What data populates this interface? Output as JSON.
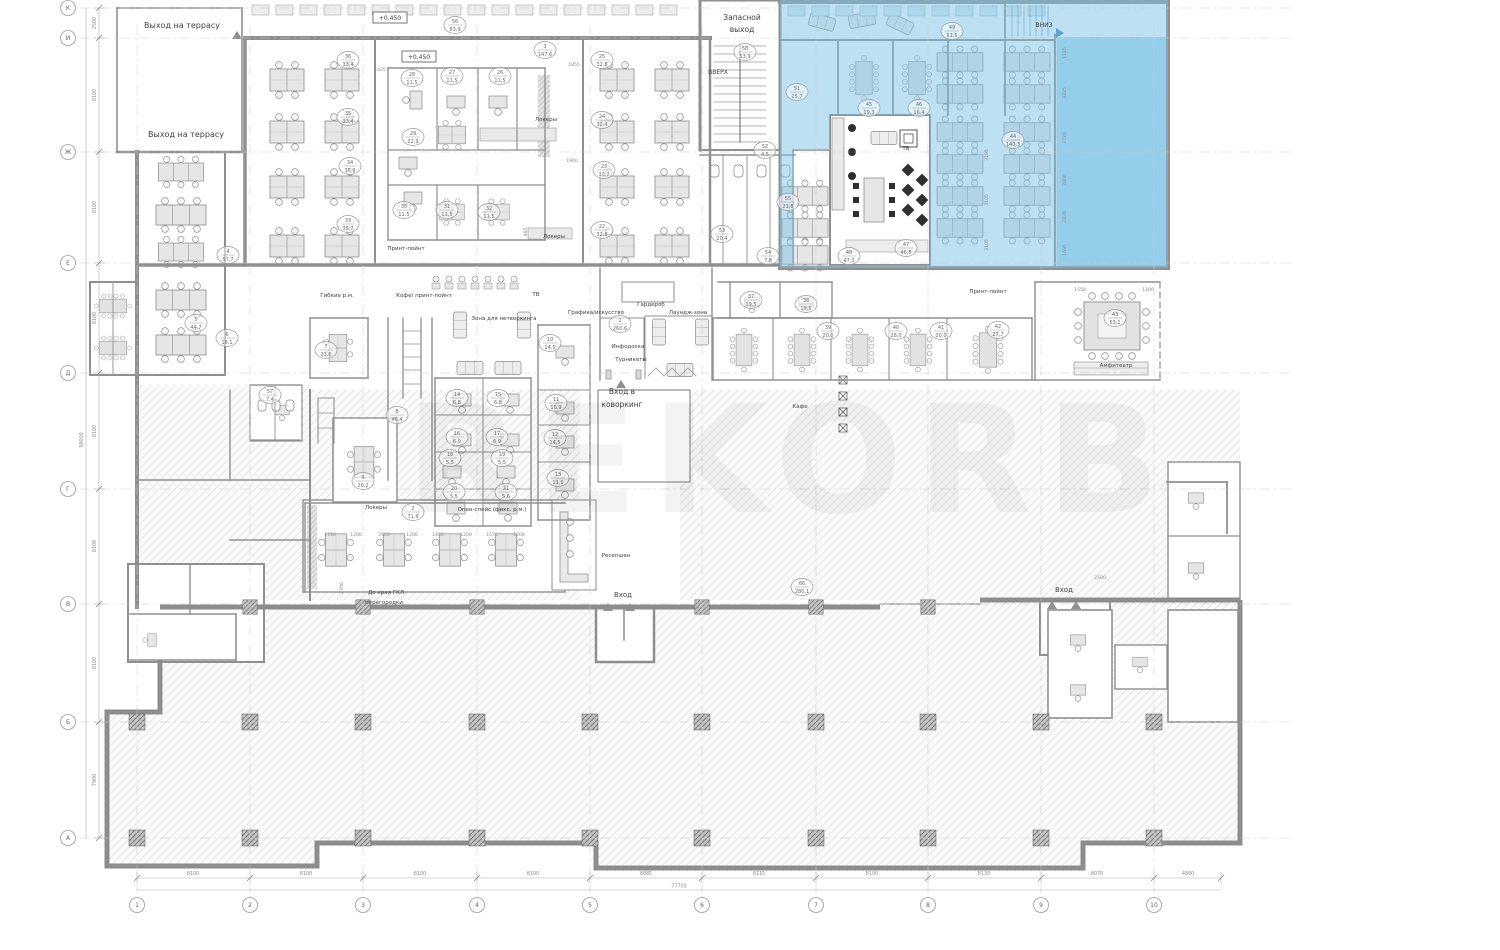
{
  "drawing": {
    "type": "architectural-floor-plan",
    "floor_note": "office coworking floor plan with highlighted lease zone",
    "watermark": {
      "text": "REKORB",
      "opacity": 0.045
    }
  },
  "colors": {
    "blue": "#7cc4e8",
    "blue_deep": "#64b7e2",
    "wall": "#8f8f8f",
    "wall_dark": "#6f6f6f",
    "furn_fill": "#e6e6e6",
    "furn_stroke": "#8f8f8f",
    "hatch_line": "#dedede",
    "label": "#3f3f3f",
    "dim": "#8a8a8a",
    "grid": "#c9c9c9"
  },
  "grid": {
    "cols": [
      {
        "label": "1",
        "x": 137
      },
      {
        "label": "2",
        "x": 250
      },
      {
        "label": "3",
        "x": 363
      },
      {
        "label": "4",
        "x": 477
      },
      {
        "label": "5",
        "x": 590
      },
      {
        "label": "6",
        "x": 702
      },
      {
        "label": "7",
        "x": 816
      },
      {
        "label": "8",
        "x": 928
      },
      {
        "label": "9",
        "x": 1041
      },
      {
        "label": "10",
        "x": 1154
      }
    ],
    "rows": [
      {
        "label": "К",
        "y": 8
      },
      {
        "label": "И",
        "y": 38
      },
      {
        "label": "Ж",
        "y": 152
      },
      {
        "label": "Е",
        "y": 263
      },
      {
        "label": "Д",
        "y": 373
      },
      {
        "label": "Г",
        "y": 489
      },
      {
        "label": "В",
        "y": 604
      },
      {
        "label": "Б",
        "y": 722
      },
      {
        "label": "А",
        "y": 838
      }
    ],
    "col_dims": [
      {
        "t": "8100",
        "x": 193
      },
      {
        "t": "8100",
        "x": 306
      },
      {
        "t": "8100",
        "x": 420
      },
      {
        "t": "8100",
        "x": 533
      },
      {
        "t": "8085",
        "x": 646
      },
      {
        "t": "8115",
        "x": 759
      },
      {
        "t": "8100",
        "x": 872
      },
      {
        "t": "8130",
        "x": 984
      },
      {
        "t": "8070",
        "x": 1097
      },
      {
        "t": "4800",
        "x": 1188
      }
    ],
    "row_dims": [
      {
        "t": "2500",
        "y": 23
      },
      {
        "t": "8100",
        "y": 95
      },
      {
        "t": "8100",
        "y": 207
      },
      {
        "t": "8100",
        "y": 318
      },
      {
        "t": "8100",
        "y": 431
      },
      {
        "t": "8100",
        "y": 546
      },
      {
        "t": "8100",
        "y": 663
      },
      {
        "t": "7900",
        "y": 780
      }
    ],
    "overall_width": "77700",
    "overall_height": "59000"
  },
  "annotations": [
    {
      "t": "Выход на террасу",
      "x": 182,
      "y": 28,
      "s": 8
    },
    {
      "t": "Выход на террасу",
      "x": 186,
      "y": 137,
      "s": 8
    },
    {
      "t": "+0,450",
      "x": 390,
      "y": 20,
      "s": 6,
      "box": true
    },
    {
      "t": "+0,450",
      "x": 419,
      "y": 59,
      "s": 6,
      "box": true
    },
    {
      "t": "Запасной",
      "x": 742,
      "y": 20,
      "s": 7.5
    },
    {
      "t": "выход",
      "x": 742,
      "y": 32,
      "s": 7.5
    },
    {
      "t": "ВВЕРХ",
      "x": 718,
      "y": 74,
      "s": 6
    },
    {
      "t": "ВНИЗ",
      "x": 1044,
      "y": 27,
      "s": 6
    },
    {
      "t": "Принт-пойнт",
      "x": 406,
      "y": 250,
      "s": 5.5
    },
    {
      "t": "Локеры",
      "x": 546,
      "y": 121,
      "s": 5.5
    },
    {
      "t": "Локеры",
      "x": 554,
      "y": 238,
      "s": 5.5
    },
    {
      "t": "Гибкие р.м.",
      "x": 337,
      "y": 297,
      "s": 5.5
    },
    {
      "t": "Кофе/ принт-пойнт",
      "x": 424,
      "y": 297,
      "s": 5.5
    },
    {
      "t": "ТВ",
      "x": 536,
      "y": 296,
      "s": 5.5
    },
    {
      "t": "Гардероб",
      "x": 651,
      "y": 306,
      "s": 5.5
    },
    {
      "t": "Графика/искусство",
      "x": 596,
      "y": 314,
      "s": 5.5
    },
    {
      "t": "Лаундж-зона",
      "x": 688,
      "y": 314,
      "s": 5.5
    },
    {
      "t": "Зона для нетворкинга",
      "x": 504,
      "y": 320,
      "s": 5.5
    },
    {
      "t": "Инфодоска",
      "x": 628,
      "y": 348,
      "s": 5.5
    },
    {
      "t": "Турникеты",
      "x": 631,
      "y": 361,
      "s": 5.5
    },
    {
      "t": "Вход в",
      "x": 622,
      "y": 394,
      "s": 7.5
    },
    {
      "t": "коворкинг",
      "x": 622,
      "y": 407,
      "s": 7.5
    },
    {
      "t": "Кафе",
      "x": 800,
      "y": 408,
      "s": 5.5
    },
    {
      "t": "Опен-спейс (фикс. р.м.)",
      "x": 492,
      "y": 511,
      "s": 5.5
    },
    {
      "t": "Локеры",
      "x": 376,
      "y": 509,
      "s": 5.5
    },
    {
      "t": "Ресепшен",
      "x": 616,
      "y": 557,
      "s": 5.5
    },
    {
      "t": "До края ГКЛ",
      "x": 386,
      "y": 594,
      "s": 5.5
    },
    {
      "t": "перегородки",
      "x": 384,
      "y": 604,
      "s": 5.5
    },
    {
      "t": "Вход",
      "x": 623,
      "y": 597,
      "s": 7
    },
    {
      "t": "Вход",
      "x": 1064,
      "y": 592,
      "s": 7
    },
    {
      "t": "Амфитеатр",
      "x": 1116,
      "y": 367,
      "s": 5.5
    },
    {
      "t": "Принт-пойнт",
      "x": 988,
      "y": 293,
      "s": 5.5
    },
    {
      "t": "ТВ",
      "x": 906,
      "y": 150,
      "s": 5.5
    }
  ],
  "inline_dims": [
    {
      "t": "1425",
      "x": 380,
      "y": 71
    },
    {
      "t": "1855",
      "x": 574,
      "y": 66
    },
    {
      "t": "1960",
      "x": 572,
      "y": 162
    },
    {
      "t": "965",
      "x": 527,
      "y": 232,
      "r": -90
    },
    {
      "t": "1558",
      "x": 1080,
      "y": 291
    },
    {
      "t": "1200",
      "x": 1148,
      "y": 291
    },
    {
      "t": "2300",
      "x": 343,
      "y": 588,
      "r": -90
    },
    {
      "t": "1710",
      "x": 330,
      "y": 536
    },
    {
      "t": "1200",
      "x": 356,
      "y": 536
    },
    {
      "t": "2560",
      "x": 384,
      "y": 536
    },
    {
      "t": "1200",
      "x": 412,
      "y": 536
    },
    {
      "t": "1655",
      "x": 438,
      "y": 536
    },
    {
      "t": "1200",
      "x": 466,
      "y": 536
    },
    {
      "t": "1575",
      "x": 492,
      "y": 536
    },
    {
      "t": "1200",
      "x": 519,
      "y": 536
    },
    {
      "t": "2500",
      "x": 1100,
      "y": 579
    },
    {
      "t": "1185",
      "x": 1066,
      "y": 53,
      "r": -90
    },
    {
      "t": "3225",
      "x": 1066,
      "y": 93,
      "r": -90
    },
    {
      "t": "3720",
      "x": 1066,
      "y": 138,
      "r": -90
    },
    {
      "t": "2000",
      "x": 1066,
      "y": 180,
      "r": -90
    },
    {
      "t": "3230",
      "x": 1066,
      "y": 217,
      "r": -90
    },
    {
      "t": "1695",
      "x": 1066,
      "y": 250,
      "r": -90
    },
    {
      "t": "3195",
      "x": 988,
      "y": 155,
      "r": -90
    },
    {
      "t": "3105",
      "x": 988,
      "y": 200,
      "r": -90
    },
    {
      "t": "3105",
      "x": 988,
      "y": 245,
      "r": -90
    }
  ],
  "rooms": [
    {
      "n": "56",
      "a": "83,9",
      "x": 455,
      "y": 25
    },
    {
      "n": "3",
      "a": "147,6",
      "x": 545,
      "y": 50
    },
    {
      "n": "36",
      "a": "33,4",
      "x": 348,
      "y": 60
    },
    {
      "n": "35",
      "a": "33,4",
      "x": 348,
      "y": 117
    },
    {
      "n": "34",
      "a": "35,9",
      "x": 350,
      "y": 166
    },
    {
      "n": "33",
      "a": "35,7",
      "x": 348,
      "y": 224
    },
    {
      "n": "28",
      "a": "11,5",
      "x": 412,
      "y": 78
    },
    {
      "n": "27",
      "a": "11,5",
      "x": 452,
      "y": 76
    },
    {
      "n": "26",
      "a": "11,5",
      "x": 500,
      "y": 76
    },
    {
      "n": "29",
      "a": "22,9",
      "x": 413,
      "y": 137
    },
    {
      "n": "30",
      "a": "11,5",
      "x": 404,
      "y": 210
    },
    {
      "n": "31",
      "a": "11,5",
      "x": 447,
      "y": 210
    },
    {
      "n": "32",
      "a": "11,5",
      "x": 489,
      "y": 212
    },
    {
      "n": "25",
      "a": "32,8",
      "x": 602,
      "y": 60
    },
    {
      "n": "24",
      "a": "32,4",
      "x": 602,
      "y": 120
    },
    {
      "n": "23",
      "a": "33,7",
      "x": 604,
      "y": 170
    },
    {
      "n": "22",
      "a": "32,8",
      "x": 602,
      "y": 230
    },
    {
      "n": "58",
      "a": "53,9",
      "x": 745,
      "y": 52
    },
    {
      "n": "51",
      "a": "25,7",
      "x": 797,
      "y": 92
    },
    {
      "n": "52",
      "a": "4,5",
      "x": 765,
      "y": 150
    },
    {
      "n": "55",
      "a": "21,8",
      "x": 788,
      "y": 202
    },
    {
      "n": "53",
      "a": "20,4",
      "x": 722,
      "y": 234
    },
    {
      "n": "54",
      "a": "7,8",
      "x": 768,
      "y": 256
    },
    {
      "n": "48",
      "a": "47,3",
      "x": 849,
      "y": 256
    },
    {
      "n": "47",
      "a": "46,8",
      "x": 906,
      "y": 248
    },
    {
      "n": "49",
      "a": "51,5",
      "x": 952,
      "y": 31
    },
    {
      "n": "45",
      "a": "19,3",
      "x": 869,
      "y": 108
    },
    {
      "n": "46",
      "a": "16,4",
      "x": 919,
      "y": 108
    },
    {
      "n": "44",
      "a": "140,3",
      "x": 1013,
      "y": 140
    },
    {
      "n": "4",
      "a": "57,7",
      "x": 228,
      "y": 255
    },
    {
      "n": "5",
      "a": "44,7",
      "x": 196,
      "y": 323
    },
    {
      "n": "6",
      "a": "18,1",
      "x": 227,
      "y": 338
    },
    {
      "n": "7",
      "a": "23,6",
      "x": 326,
      "y": 350
    },
    {
      "n": "57",
      "a": "7,4",
      "x": 270,
      "y": 395
    },
    {
      "n": "8",
      "a": "46,4",
      "x": 397,
      "y": 415
    },
    {
      "n": "9",
      "a": "26,2",
      "x": 363,
      "y": 481
    },
    {
      "n": "1",
      "a": "260,6",
      "x": 620,
      "y": 324
    },
    {
      "n": "10",
      "a": "14,5",
      "x": 550,
      "y": 343
    },
    {
      "n": "11",
      "a": "10,9",
      "x": 556,
      "y": 403
    },
    {
      "n": "12",
      "a": "14,5",
      "x": 555,
      "y": 438
    },
    {
      "n": "13",
      "a": "11,0",
      "x": 558,
      "y": 478
    },
    {
      "n": "14",
      "a": "6,8",
      "x": 457,
      "y": 398
    },
    {
      "n": "15",
      "a": "6,8",
      "x": 498,
      "y": 398
    },
    {
      "n": "16",
      "a": "6,9",
      "x": 457,
      "y": 437
    },
    {
      "n": "17",
      "a": "6,9",
      "x": 497,
      "y": 437
    },
    {
      "n": "18",
      "a": "5,5",
      "x": 450,
      "y": 458
    },
    {
      "n": "19",
      "a": "5,5",
      "x": 502,
      "y": 458
    },
    {
      "n": "20",
      "a": "5,5",
      "x": 454,
      "y": 492
    },
    {
      "n": "21",
      "a": "5,6",
      "x": 506,
      "y": 492
    },
    {
      "n": "2",
      "a": "71,9",
      "x": 413,
      "y": 512
    },
    {
      "n": "37",
      "a": "19,5",
      "x": 751,
      "y": 300
    },
    {
      "n": "38",
      "a": "19,5",
      "x": 806,
      "y": 304
    },
    {
      "n": "39",
      "a": "20,0",
      "x": 828,
      "y": 331
    },
    {
      "n": "40",
      "a": "28,0",
      "x": 896,
      "y": 331
    },
    {
      "n": "41",
      "a": "20,0",
      "x": 941,
      "y": 331
    },
    {
      "n": "42",
      "a": "27,7",
      "x": 998,
      "y": 330
    },
    {
      "n": "43",
      "a": "53,1",
      "x": 1115,
      "y": 318
    },
    {
      "n": "66",
      "a": "280,1",
      "x": 802,
      "y": 587
    }
  ]
}
